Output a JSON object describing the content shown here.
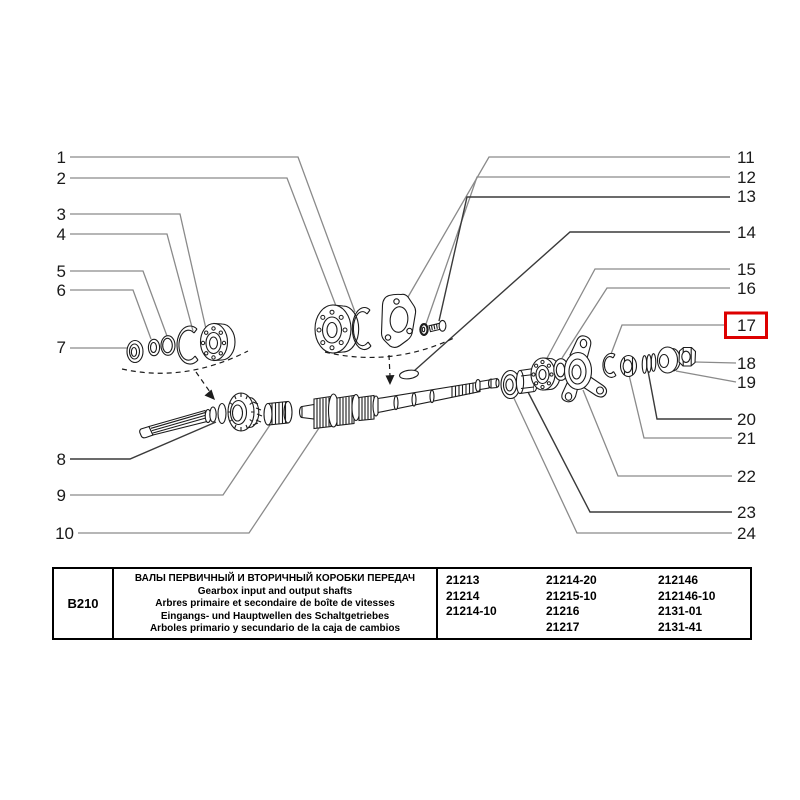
{
  "diagram": {
    "callouts_left": [
      "1",
      "2",
      "3",
      "4",
      "5",
      "6",
      "7",
      "8",
      "9",
      "10"
    ],
    "callouts_right": [
      "11",
      "12",
      "13",
      "14",
      "15",
      "16",
      "17",
      "18",
      "19",
      "20",
      "21",
      "22",
      "23",
      "24"
    ],
    "highlighted_callout": "17",
    "highlight_color": "#dd0000"
  },
  "table": {
    "code": "B210",
    "titles": [
      "ВАЛЫ ПЕРВИЧНЫЙ И ВТОРИЧНЫЙ КОРОБКИ ПЕРЕДАЧ",
      "Gearbox input and output shafts",
      "Arbres primaire et secondaire de boîte de vitesses",
      "Eingangs- und Hauptwellen des Schaltgetriebes",
      "Arboles primario y secundario de la caja de cambios"
    ],
    "part_numbers": {
      "col1": [
        "21213",
        "21214",
        "21214-10"
      ],
      "col2": [
        "21214-20",
        "21215-10",
        "21216",
        "21217"
      ],
      "col3": [
        "212146",
        "212146-10",
        "2131-01",
        "2131-41"
      ]
    }
  }
}
